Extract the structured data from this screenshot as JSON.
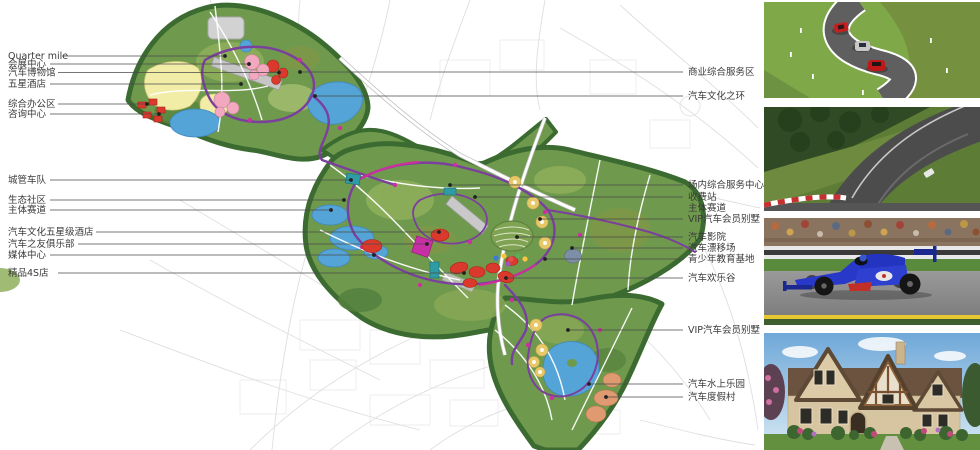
{
  "figure": {
    "kind": "auto-theme-park-master-plan",
    "colors": {
      "plan_green": "#6f9a4d",
      "border_green": "#3c6b31",
      "lake_blue": "#55a4d8",
      "track_purple": "#7b3f9e",
      "accent_magenta": "#cc2f9e",
      "building_red": "#dc392d",
      "building_pink": "#f2a9c0",
      "building_yellow": "#e7c869",
      "building_orange": "#e09a72",
      "zone_yellow": "#f1eda6"
    }
  },
  "labels": {
    "left": [
      {
        "text": "Quarter mile"
      },
      {
        "text": "会展中心"
      },
      {
        "text": "汽车博物馆"
      },
      {
        "text": "五星酒店"
      },
      {
        "text": "综合办公区"
      },
      {
        "text": "咨询中心"
      },
      {
        "text": "城管车队"
      },
      {
        "text": "生态社区"
      },
      {
        "text": "主体赛道"
      },
      {
        "text": "汽车文化五星级酒店"
      },
      {
        "text": "汽车之友俱乐部"
      },
      {
        "text": "媒体中心"
      },
      {
        "text": "精品4S店"
      }
    ],
    "right": [
      {
        "text": "商业综合服务区"
      },
      {
        "text": "汽车文化之环"
      },
      {
        "text": "场内综合服务中心"
      },
      {
        "text": "收费站"
      },
      {
        "text": "主体赛道"
      },
      {
        "text": "VIP汽车会员别墅"
      },
      {
        "text": "汽车影院"
      },
      {
        "text": "汽车漂移场"
      },
      {
        "text": "青少年教育基地"
      },
      {
        "text": "汽车欢乐谷"
      },
      {
        "text": "VIP汽车会员别墅"
      },
      {
        "text": "汽车水上乐园"
      },
      {
        "text": "汽车度假村"
      }
    ]
  },
  "photos": [
    {
      "name": "winding-test-road-with-cars"
    },
    {
      "name": "race-track-corner-aerial"
    },
    {
      "name": "formula-one-race-car"
    },
    {
      "name": "luxury-villa-exterior"
    }
  ]
}
